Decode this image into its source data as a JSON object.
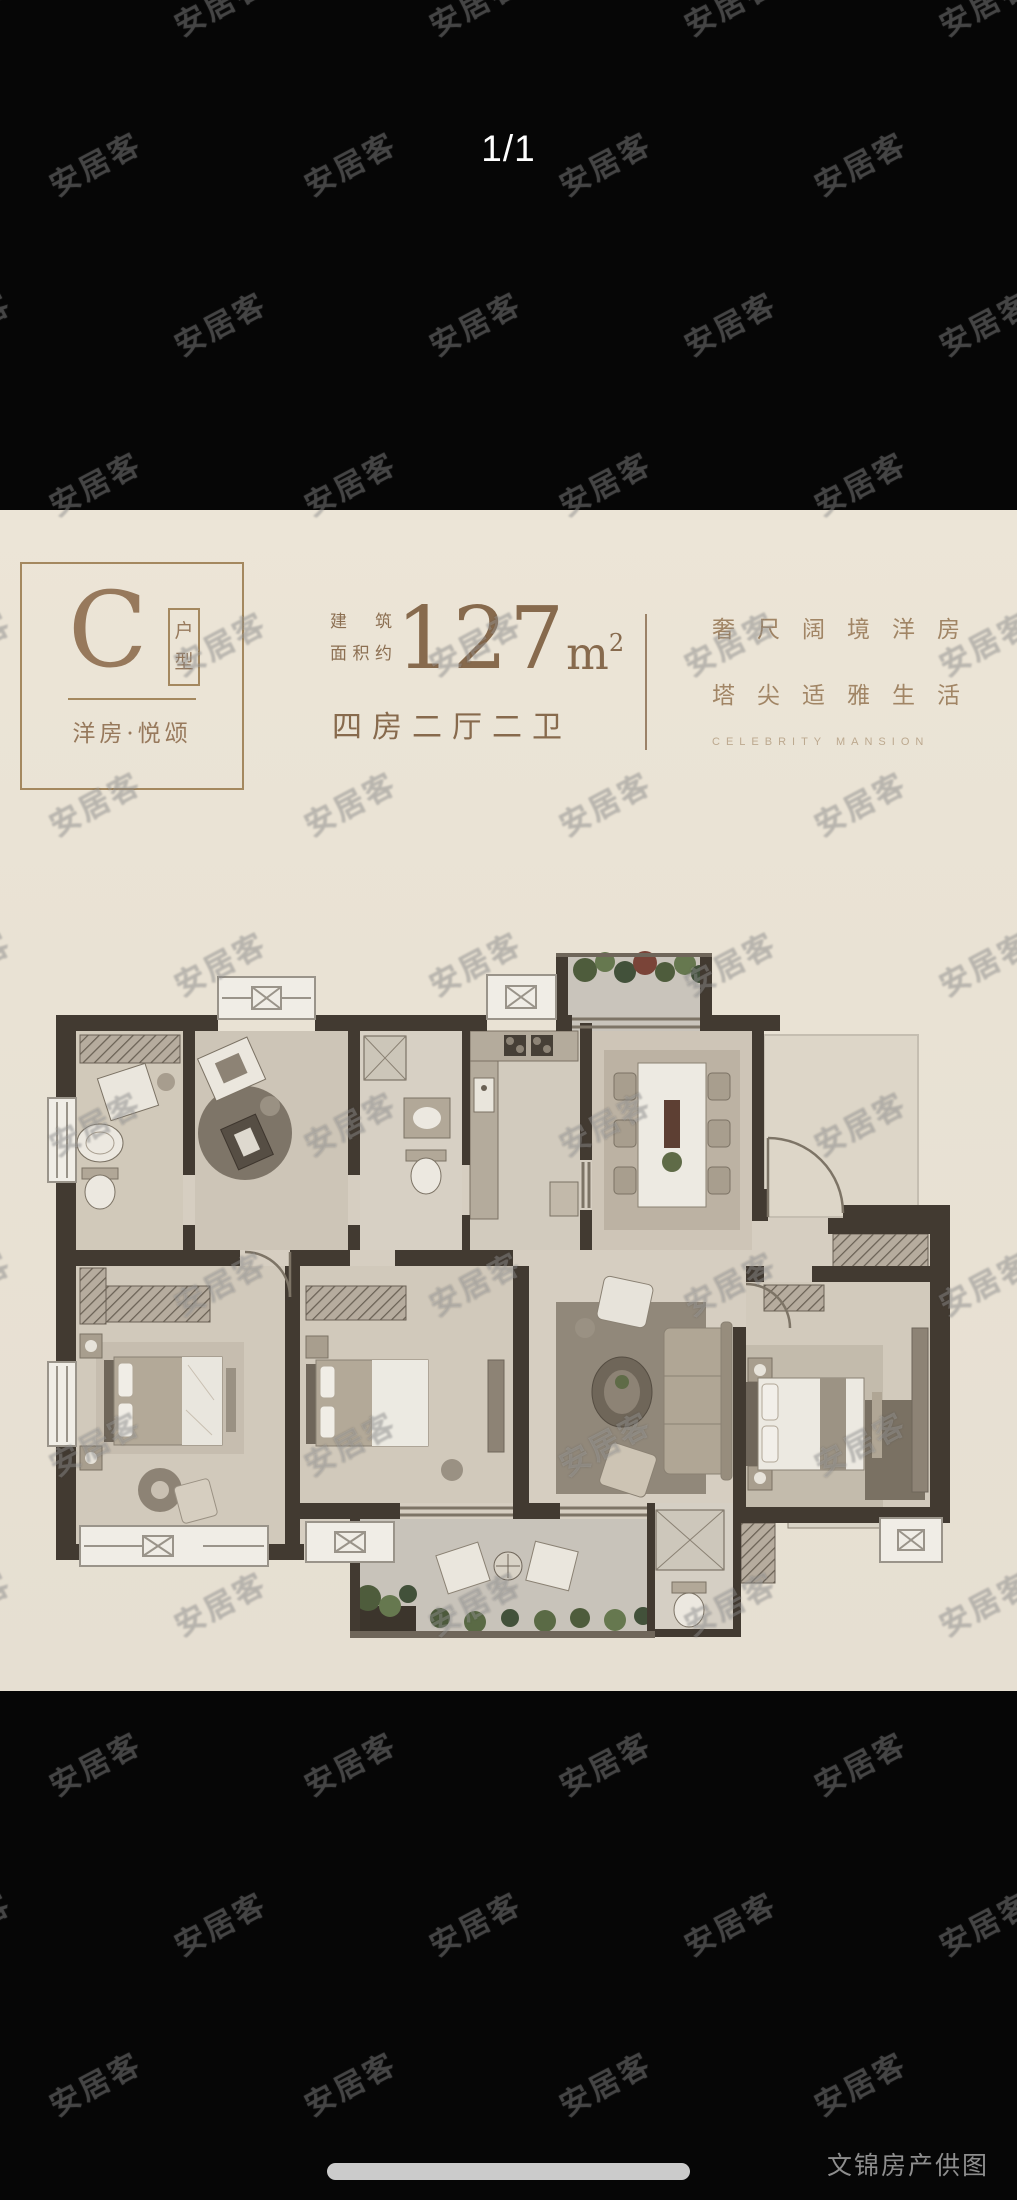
{
  "pager": {
    "label": "1/1"
  },
  "watermark": {
    "text": "安居客"
  },
  "caption": {
    "text": "文锦房产供图"
  },
  "title_block": {
    "type_letter": "C",
    "type_box_char1": "户",
    "type_box_char2": "型",
    "subtitle": "洋房·悦颂",
    "area_label_line1": "建筑",
    "area_label_line2": "面积约",
    "area_value": "127",
    "area_unit_base": "m",
    "area_unit_exp": "2",
    "layout_label": "四房二厅二卫",
    "slogan_cn_line1": "奢尺阔境洋房",
    "slogan_cn_line2": "塔尖适雅生活",
    "slogan_en": "CELEBRITY MANSION"
  },
  "colors": {
    "accent_brown": "#97795c",
    "area_text": "#876a4d",
    "plate_bg": "#e9e2d4",
    "wall": "#423a31",
    "pager_text": "#ffffff",
    "caption_text": "#8e8e8e"
  }
}
